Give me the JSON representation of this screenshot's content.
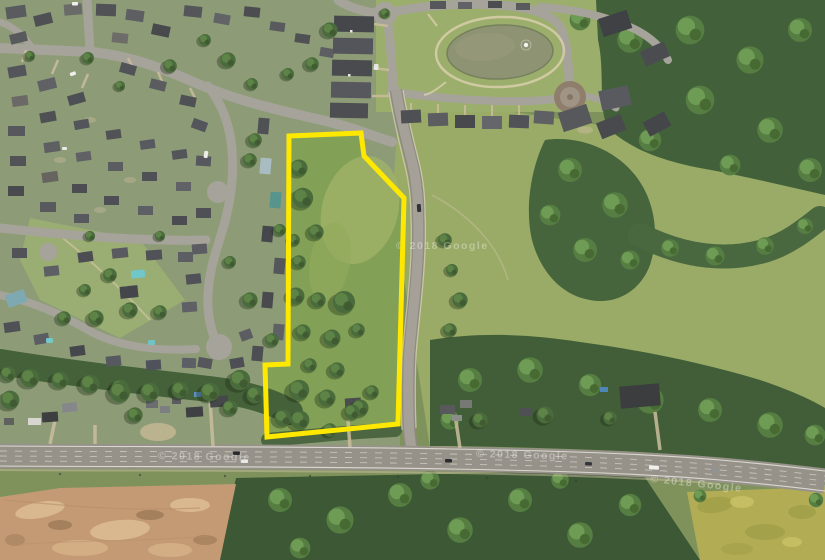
{
  "scene": {
    "description": "Aerial satellite photo of a residential neighborhood, pond, highway and wooded land with a vacant parcel outlined",
    "watermark": "© 2018 Google"
  },
  "boundary": {
    "color": "#ffe800"
  },
  "palette": {
    "grass": "#7f925c",
    "lawn": "#8d9c77",
    "meadow": "#99ab67",
    "forest": "#42603a",
    "pond": "#8e9374",
    "street": "#a6a39a",
    "highway": "#96928a",
    "dirt": "#c39a74",
    "field": "#b2ad55",
    "path": "#d8cfac"
  }
}
